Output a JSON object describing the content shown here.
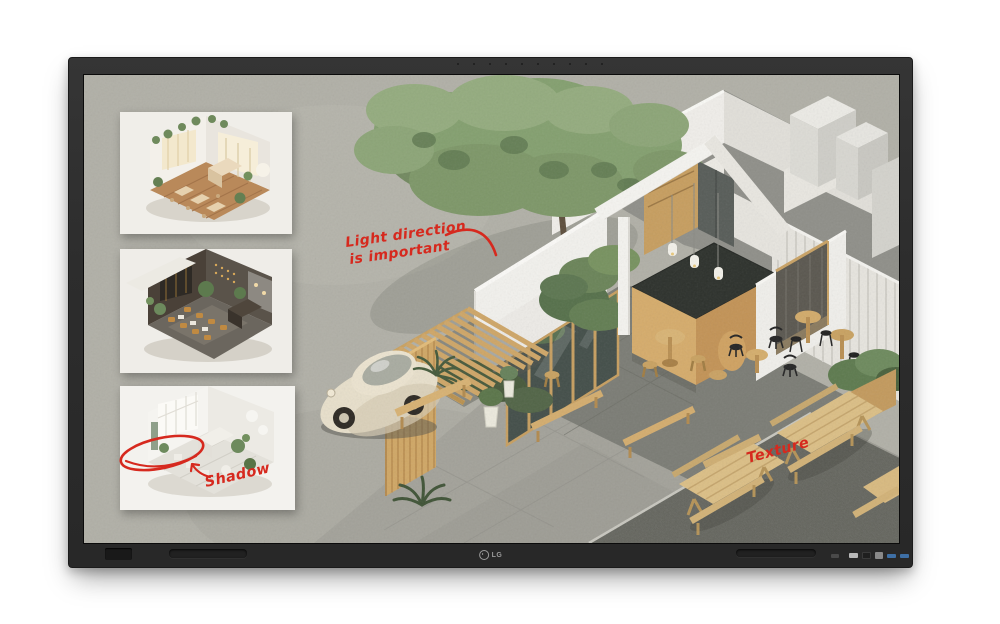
{
  "device": {
    "brand": "LG"
  },
  "screen_annotations": {
    "ink_color": "#d6291e",
    "light_direction_line1": "Light direction",
    "light_direction_line2": "is important",
    "shadow_label": "Shadow",
    "texture_label": "Texture"
  },
  "render": {
    "cafe_sign": "CAFE"
  },
  "colors": {
    "concrete": "#b1b0a7",
    "dark_pavement": "#606159",
    "wood": "#d0a765",
    "foliage": "#84a06f",
    "wall_white": "#f2f1ed",
    "bezel": "#2e2e2e"
  }
}
